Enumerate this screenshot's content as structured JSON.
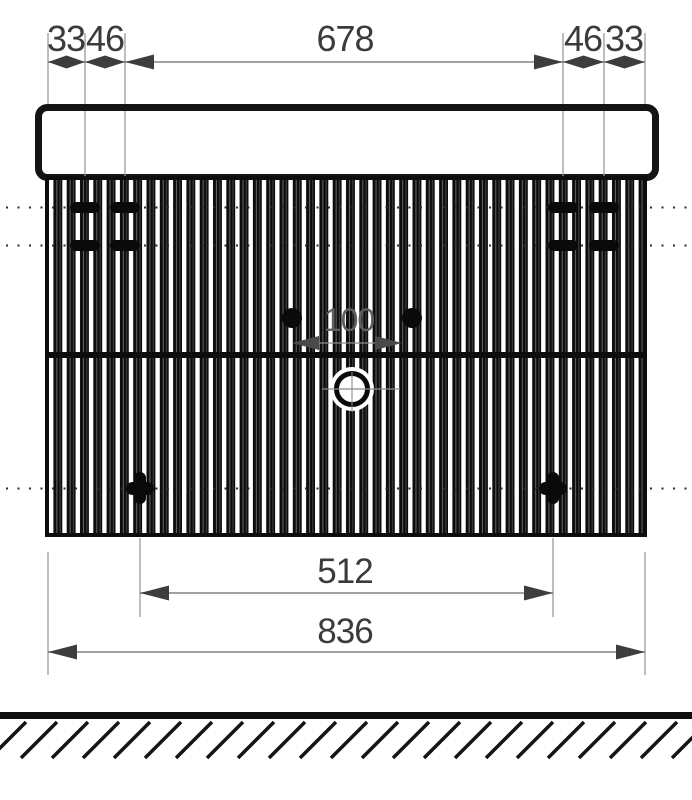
{
  "drawing": {
    "background": "#ffffff",
    "colors": {
      "ink": "#141414",
      "dim_line": "#848484",
      "dim_text": "#3b3b3b",
      "inner_dim_text": "#5f5f5f"
    },
    "dimensions": {
      "top_left_edge": "33",
      "top_left_offset": "46",
      "top_span": "678",
      "top_right_offset": "46",
      "top_right_edge": "33",
      "faucet_hole_spacing": "100",
      "lower_mount_spacing": "512",
      "overall_width": "836"
    }
  }
}
